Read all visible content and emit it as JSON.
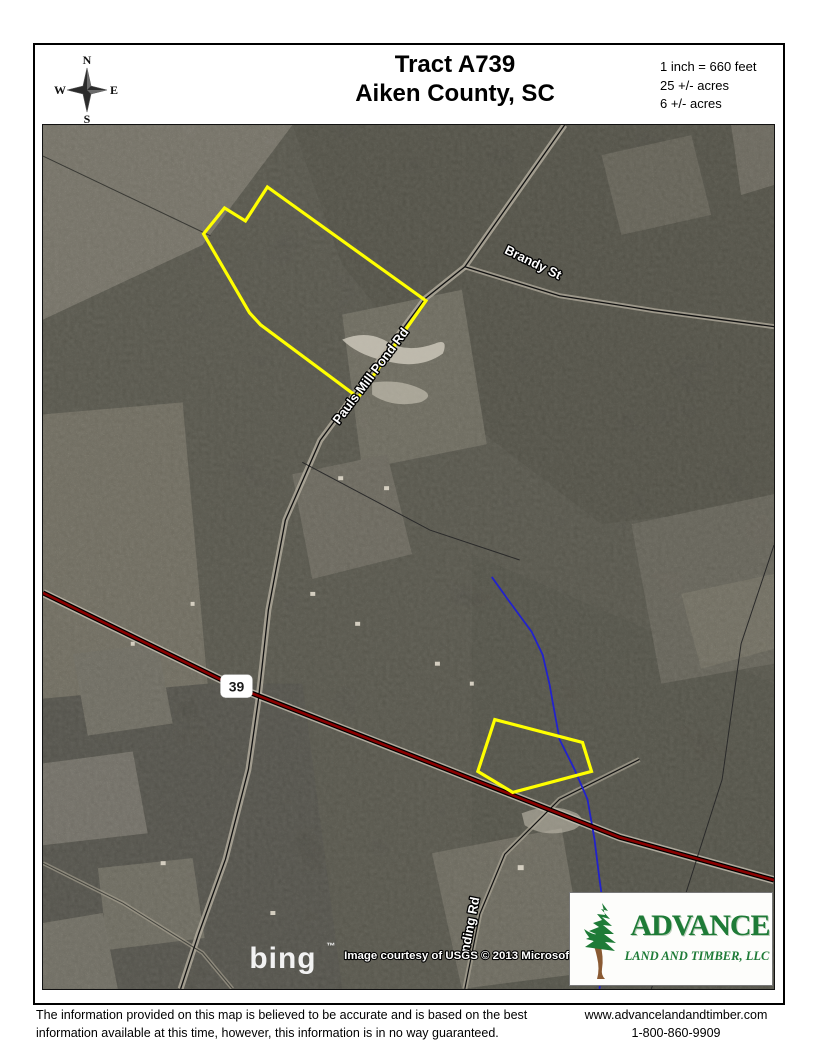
{
  "header": {
    "title_line1": "Tract A739",
    "title_line2": "Aiken County, SC",
    "scale_line1": "1 inch = 660 feet",
    "scale_line2": "25 +/- acres",
    "scale_line3": "6 +/- acres",
    "compass": {
      "n": "N",
      "e": "E",
      "s": "S",
      "w": "W"
    }
  },
  "map": {
    "labels": {
      "brandy_street": "Brandy St",
      "main_road": "Pauls Mill Pond Rd",
      "landing_road": "nding Rd",
      "highway_shield": "39"
    },
    "attribution": "Image courtesy of USGS © 2013 Microsoft C",
    "bing_logo": "bing",
    "bing_tm": "™",
    "colors": {
      "tract_boundary": "#ffff00",
      "highway": "#8b0000",
      "stream": "#2222cc",
      "road_line": "#111111"
    },
    "geometry": {
      "tract_25ac": "225,62 203,96 182,83 161,109 207,188 218,200 316,273 384,176",
      "tract_6ac": "453,596 541,619 550,648 471,669 436,648",
      "highway_39": "0,469 195,564 390,640 578,714 733,757",
      "main_road": "523,0 423,142 383,174 278,316 243,396 226,486 216,576 206,646 183,736 156,811 138,866",
      "brandy_street": "423,142 518,171 613,186 733,202",
      "landing_road": "598,636 518,676 463,731 438,791 423,866",
      "stream": "450,453 465,474 490,508 501,531 508,561 511,578 518,616 533,646 546,676 553,716 558,756 565,806 558,866",
      "parcel_line_right": "733,421 700,520 681,656 645,769 610,866",
      "parcel_line_center": "260,338 388,406 478,436",
      "field_edge_topleft": "0,31 168,111",
      "minor_road_sw": "0,740 80,780 160,830 190,866"
    }
  },
  "logo": {
    "name": "ADVANCE",
    "subtitle": "LAND AND TIMBER, LLC"
  },
  "footer": {
    "disclaimer_line1": "The information provided on this map is believed to be accurate and is based on the best",
    "disclaimer_line2": "information available at this time, however, this information is in no way guaranteed.",
    "website": "www.advancelandandtimber.com",
    "phone": "1-800-860-9909"
  }
}
